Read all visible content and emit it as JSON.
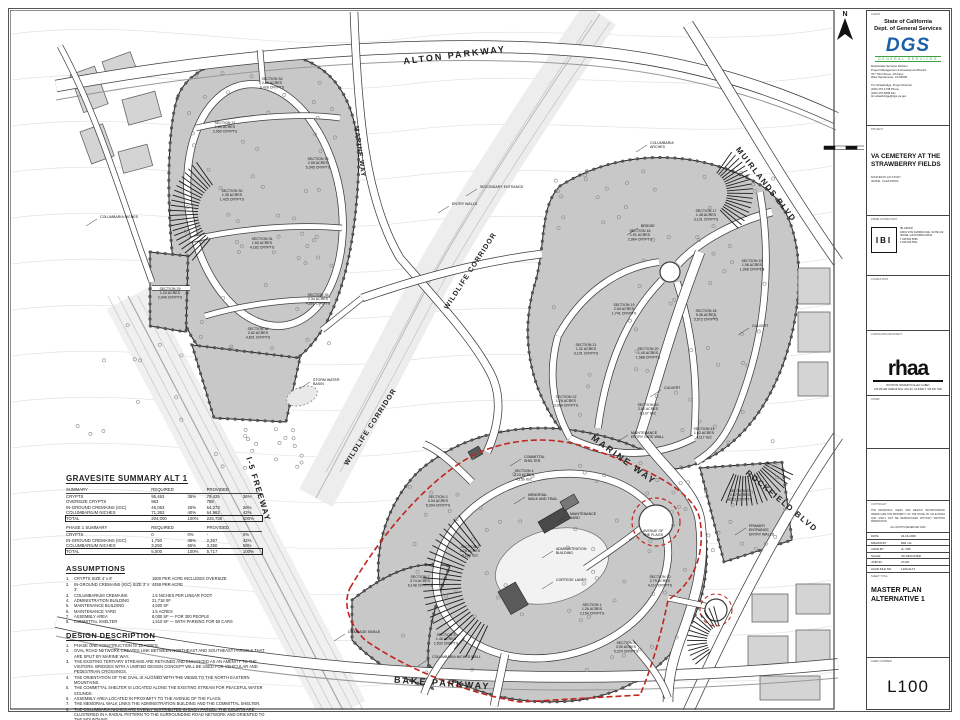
{
  "colors": {
    "accent_red": "#c0251f",
    "dgs_blue": "#1b5fa8",
    "dgs_green": "#3da144",
    "parcel_gray": "#c8c8c8"
  },
  "sheet": {
    "client": {
      "label": "CLIENT",
      "line1": "State of California",
      "line2": "Dept. of General Services",
      "logo": "DGS",
      "logo_sub": "GENERAL SERVICES",
      "address": [
        "Real Estate Services Division",
        "Project Management & Development Branch",
        "707 Third Street, 4th Floor",
        "West Sacramento, CA 95605"
      ],
      "contact": [
        "Tim Strawbridge, Project Director",
        "(916) 376-1748 Phone",
        "(916) 376-5008 Fax",
        "tim.strawbridge@dgs.ca.gov"
      ]
    },
    "project": {
      "label": "PROJECT",
      "title": "VA CEMETERY AT THE STRAWBERRY FIELDS",
      "sub1": "MASTER PLAN STUDY",
      "sub2": "IRVINE, CALIFORNIA"
    },
    "prime": {
      "label": "PRIME CONSULTANT",
      "logo": "IBI",
      "info": [
        "IBI GROUP",
        "18401 VON KARMAN AVE, SUITE 110",
        "IRVINE, CALIFORNIA 92612",
        "T 949 833 5588",
        "F 949 833 5511"
      ]
    },
    "consultant_label": "CONSULTANT",
    "landscape": {
      "label": "LANDSCAPE ARCHITECT",
      "logo": "rhaa",
      "info": [
        "ROYSTON HANAMOTO ALLEY & ABEY",
        "225 MILLER AVENUE  MILL VALLEY, CA 94941  T 415 383 7900"
      ]
    },
    "stamp_label": "STAMP",
    "note": {
      "label": "COPYRIGHT",
      "lines": [
        "THE DRAWINGS, IDEAS AND DESIGN INCORPORATED HEREIN ARE THE PROPERTY OF THE STATE OF CALIFORNIA AND SHALL NOT BE REPRODUCED WITHOUT WRITTEN PERMISSION.",
        "ALL RIGHTS RESERVED 2009"
      ]
    },
    "fields": [
      {
        "k": "DATE",
        "v": "04-16-2009"
      },
      {
        "k": "DRAWN BY",
        "v": "MW / AL"
      },
      {
        "k": "CHKD BY",
        "v": "JL / RB"
      },
      {
        "k": "SCALE",
        "v": "AS INDICATED"
      },
      {
        "k": "JOB NO.",
        "v": "27143"
      },
      {
        "k": "ACAD FILE NO.",
        "v": "L100-ALT1"
      }
    ],
    "sheet_title": {
      "label": "SHEET TITLE",
      "line1": "MASTER PLAN",
      "line2": "ALTERNATIVE 1"
    },
    "sheet_number": {
      "label": "SHEET NUMBER",
      "value": "L100"
    },
    "north": "N"
  },
  "panel": {
    "title": "GRAVESITE SUMMARY ALT 1",
    "summary": {
      "headers": [
        "SUMMARY",
        "REQUIRED",
        "",
        "PROVIDED",
        ""
      ],
      "rows": [
        [
          "CRYPTS",
          "95,463",
          "35%",
          "79,425",
          "36%"
        ],
        [
          "OVERSIZE CRYPTS",
          "963",
          "",
          "788",
          ""
        ],
        [
          "IN-GROUND CREMAINS (IGC)",
          "45,063",
          "25%",
          "54,273",
          "26%"
        ],
        [
          "COLUMBARIUM NICHES",
          "71,363",
          "40%",
          "64,962",
          "42%"
        ]
      ],
      "total": [
        "TOTAL",
        "204,000",
        "100%",
        "225,730",
        "100%"
      ]
    },
    "phase1": {
      "headers": [
        "PHASE 1 SUMMARY",
        "REQUIRED",
        "",
        "PROVIDED",
        ""
      ],
      "rows": [
        [
          "CRYPTS",
          "0",
          "0%",
          "-",
          "0%"
        ],
        [
          "IN-GROUND CREMAINS (IGC)",
          "1,750",
          "35%",
          "2,367",
          "42%"
        ],
        [
          "COLUMBARIUM NICHES",
          "3,250",
          "65%",
          "3,350",
          "58%"
        ]
      ],
      "total": [
        "TOTAL",
        "5,000",
        "100%",
        "5,717",
        "100%"
      ]
    },
    "assumptions": {
      "title": "ASSUMPTIONS",
      "items": [
        [
          "CRYPTS SIZE 4' x 8'",
          "1500 PER ACRE INCLUDES OVERSIZE"
        ],
        [
          "IN-GROUND CREMAINS (IGC) SIZE 3' x 3'",
          "4450 PER ACRE"
        ],
        [
          "COLUMBARIUM CREMAINS",
          "1.5 NICHES PER LINEAR FOOT"
        ],
        [
          "ADMINISTRATION BUILDING",
          "21,718 SF"
        ],
        [
          "MAINTENANCE BUILDING",
          "4,500 SF"
        ],
        [
          "MAINTENANCE YARD",
          "1.5 ACRES"
        ],
        [
          "ASSEMBLY AREA",
          "8,000 SF — FOR 300 PEOPLE"
        ],
        [
          "COMMITTAL SHELTER",
          "1,510 SF — WITH PARKING FOR 50 CARS"
        ]
      ]
    },
    "design": {
      "title": "DESIGN DESCRIPTION",
      "items": [
        "PHASE ONE CONSTRUCTION IS 15 ACRES.",
        "OVAL ROAD NETWORK CREATES LINK BETWEEN NORTHEAST AND SOUTHEAST PARCELS THAT ARE SPLIT BY MARINE WAY.",
        "THE EXISTING TERTIARY STREAMS ARE RETAINED AND ENHANCED AS AN AMENITY TO THE VISITORS. BRIDGES WITH A UNIFIED DESIGN CONCEPT WILL BE USED FOR VEHICULAR AND PEDESTRIAN CROSSINGS.",
        "THE ORIENTATION OF THE OVAL IS ALIGNED WITH THE VIEWS TO THE NORTH EASTERN MOUNTAINS.",
        "THE COMMITTAL SHELTER IS LOCATED ALONG THE EXISTING STREAM FOR PEACEFUL WATER SOUNDS.",
        "ASSEMBLY AREA LOCATED IN PROXIMITY TO THE AVENUE OF THE FLAGS.",
        "THE MEMORIAL WALK LINKS THE ADMINISTRATION BUILDING AND THE COMMITTAL SHELTER.",
        "THE COLUMBARIA NICHES ARE EVENLY DISTRIBUTED IN EACH PARCEL. THE COURTS ARE CLUSTERED IN A RADIAL PATTERN TO THE SURROUNDING ROAD NETWORK AND ORIENTED TO THE MOUNTAINS.",
        "THE MAINTENANCE YARD HAS ITS OWN SEPARATE ENTRANCE AND EXIT."
      ]
    }
  },
  "map": {
    "streets": [
      {
        "t": "ALTON PARKWAY",
        "x": 455,
        "y": 58,
        "r": -7,
        "s": 9,
        "ls": 2
      },
      {
        "t": "MARINE WAY",
        "x": 358,
        "y": 152,
        "r": 82,
        "s": 6.5,
        "ls": 1
      },
      {
        "t": "WILDLIFE CORRIDOR",
        "x": 472,
        "y": 272,
        "r": -57,
        "s": 7,
        "ls": 1
      },
      {
        "t": "WILDLIFE CORRIDOR",
        "x": 372,
        "y": 428,
        "r": -57,
        "s": 7,
        "ls": 1
      },
      {
        "t": "MUIRLANDS BLVD",
        "x": 764,
        "y": 186,
        "r": 52,
        "s": 8,
        "ls": 1.5
      },
      {
        "t": "MARINE WAY",
        "x": 622,
        "y": 462,
        "r": 36,
        "s": 9,
        "ls": 2
      },
      {
        "t": "I-5 FREEWAY",
        "x": 256,
        "y": 490,
        "r": 73,
        "s": 8,
        "ls": 1.5
      },
      {
        "t": "ROCKFIELD BLVD",
        "x": 780,
        "y": 503,
        "r": 40,
        "s": 8,
        "ls": 1.5
      },
      {
        "t": "BAKE PARKWAY",
        "x": 442,
        "y": 686,
        "r": 4,
        "s": 9,
        "ls": 2
      }
    ],
    "callouts": [
      {
        "lines": [
          "COLUMBARIA",
          "ARCHES"
        ],
        "x": 650,
        "y": 144
      },
      {
        "lines": [
          "SECONDARY ENTRANCE"
        ],
        "x": 480,
        "y": 188
      },
      {
        "lines": [
          "ENTRY WALLS"
        ],
        "x": 452,
        "y": 205
      },
      {
        "lines": [
          "COLUMBARIA NICHES"
        ],
        "x": 100,
        "y": 218
      },
      {
        "lines": [
          "STORM WATER",
          "BASIN"
        ],
        "x": 313,
        "y": 381
      },
      {
        "lines": [
          "BRIDGE"
        ],
        "x": 641,
        "y": 227
      },
      {
        "lines": [
          "CULVERT"
        ],
        "x": 752,
        "y": 327
      },
      {
        "lines": [
          "CULVERT"
        ],
        "x": 664,
        "y": 389
      },
      {
        "lines": [
          "MAINTENANCE",
          "ENTRY GATE WALL"
        ],
        "x": 631,
        "y": 434
      },
      {
        "lines": [
          "COMMITTAL",
          "SHELTER"
        ],
        "x": 524,
        "y": 458
      },
      {
        "lines": [
          "MEMORIAL",
          "WALK AND TRAIL"
        ],
        "x": 528,
        "y": 496
      },
      {
        "lines": [
          "MAINTENANCE",
          "YARD"
        ],
        "x": 570,
        "y": 515
      },
      {
        "lines": [
          "ADMINISTRATION",
          "BUILDING"
        ],
        "x": 556,
        "y": 550
      },
      {
        "lines": [
          "AVENUE OF",
          "THE FLAGS"
        ],
        "x": 643,
        "y": 532
      },
      {
        "lines": [
          "CORTEGE LANES"
        ],
        "x": 556,
        "y": 581
      },
      {
        "lines": [
          "PRIMARY",
          "ENTRANCE",
          "ENTRY WALLS"
        ],
        "x": 749,
        "y": 527
      },
      {
        "lines": [
          "DRAINAGE SWALE"
        ],
        "x": 348,
        "y": 633
      },
      {
        "lines": [
          "COLUMBARIA NICHES WALL"
        ],
        "x": 432,
        "y": 658
      }
    ],
    "sections": [
      {
        "n": "SECTION 31",
        "a": "1.80 ACRES",
        "c": "2,950 CRYPTS",
        "x": 225,
        "y": 124
      },
      {
        "n": "SECTION 32",
        "a": "2.46 ACRES",
        "c": "6,428 CRYPTS",
        "x": 272,
        "y": 80
      },
      {
        "n": "SECTION 33",
        "a": "2.05 ACRES",
        "c": "5,345 CRYPTS",
        "x": 318,
        "y": 160
      },
      {
        "n": "SECTION 30",
        "a": "1.35 ACRES",
        "c": "1,425 CRYPTS",
        "x": 232,
        "y": 192
      },
      {
        "n": "SECTION 34",
        "a": "1.60 ACRES",
        "c": "4,182 CRYPTS",
        "x": 262,
        "y": 240
      },
      {
        "n": "SECTION 35",
        "a": "2.34 ACRES",
        "c": "4,861 CRYPTS",
        "x": 318,
        "y": 296
      },
      {
        "n": "SECTION 36",
        "a": "2.62 ACRES",
        "c": "4,601 CRYPTS",
        "x": 258,
        "y": 330
      },
      {
        "n": "SECTION 29",
        "a": "1.24 ACRES",
        "c": "2,040 CRYPTS",
        "x": 170,
        "y": 290
      },
      {
        "n": "SECTION 16",
        "a": "1.91 ACRES",
        "c": "2,964 CRYPTS",
        "x": 640,
        "y": 232
      },
      {
        "n": "SECTION 17",
        "a": "1.48 ACRES",
        "c": "3,131 CRYPTS",
        "x": 706,
        "y": 212
      },
      {
        "n": "SECTION 15",
        "a": "1.06 ACRES",
        "c": "1,908 CRYPTS",
        "x": 752,
        "y": 262
      },
      {
        "n": "SECTION 19",
        "a": "2.54 ACRES",
        "c": "1,741 CRYPTS",
        "x": 624,
        "y": 306
      },
      {
        "n": "SECTION 18",
        "a": "5.36 ACRES",
        "c": "5,573 CRYPTS",
        "x": 706,
        "y": 312
      },
      {
        "n": "SECTION 21",
        "a": "1.32 ACRES",
        "c": "3,191 CRYPTS",
        "x": 586,
        "y": 346
      },
      {
        "n": "SECTION 20",
        "a": "1.40 ACRES",
        "c": "1,588 CRYPTS",
        "x": 648,
        "y": 350
      },
      {
        "n": "SECTION 22",
        "a": "1.76 ACRES",
        "c": "3,064 CRYPTS",
        "x": 566,
        "y": 398
      },
      {
        "n": "SECTION 40",
        "a": "2.62 ACRES",
        "c": "6,107 IGC",
        "x": 648,
        "y": 406
      },
      {
        "n": "SECTION 41",
        "a": "1.62 ACRES",
        "c": "4,117 IGC",
        "x": 704,
        "y": 430
      },
      {
        "n": "SECTION 23",
        "a": "2.87 ACRES",
        "c": "4,311 CRYPTS",
        "x": 740,
        "y": 492
      },
      {
        "n": "SECTION 3",
        "a": "3.04 ACRES",
        "c": "5,004 CRYPTS",
        "x": 438,
        "y": 498
      },
      {
        "n": "SECTION 4",
        "a": "2.23 ACRES",
        "c": "4,150 IGC",
        "x": 524,
        "y": 472
      },
      {
        "n": "SECTION 2",
        "a": "1.76 ACRES",
        "c": "3,104 IGC",
        "x": 470,
        "y": 548
      },
      {
        "n": "SECTION 7",
        "a": "3.74 ACRES",
        "c": "6,148 CRYPTS",
        "x": 420,
        "y": 578
      },
      {
        "n": "SECTION 1",
        "a": "1.26 ACRES",
        "c": "2,154 CRYPTS",
        "x": 592,
        "y": 606
      },
      {
        "n": "SECTION 10",
        "a": "2.79 ACRES",
        "c": "4,117 CRYPTS",
        "x": 660,
        "y": 578
      },
      {
        "n": "SECTION 8",
        "a": "3.00 ACRES",
        "c": "5,224 CRYPTS",
        "x": 626,
        "y": 644
      },
      {
        "n": "SECTION 5",
        "a": "1.46 ACRES",
        "c": "2,532 CRYPTS",
        "x": 446,
        "y": 636
      }
    ]
  }
}
